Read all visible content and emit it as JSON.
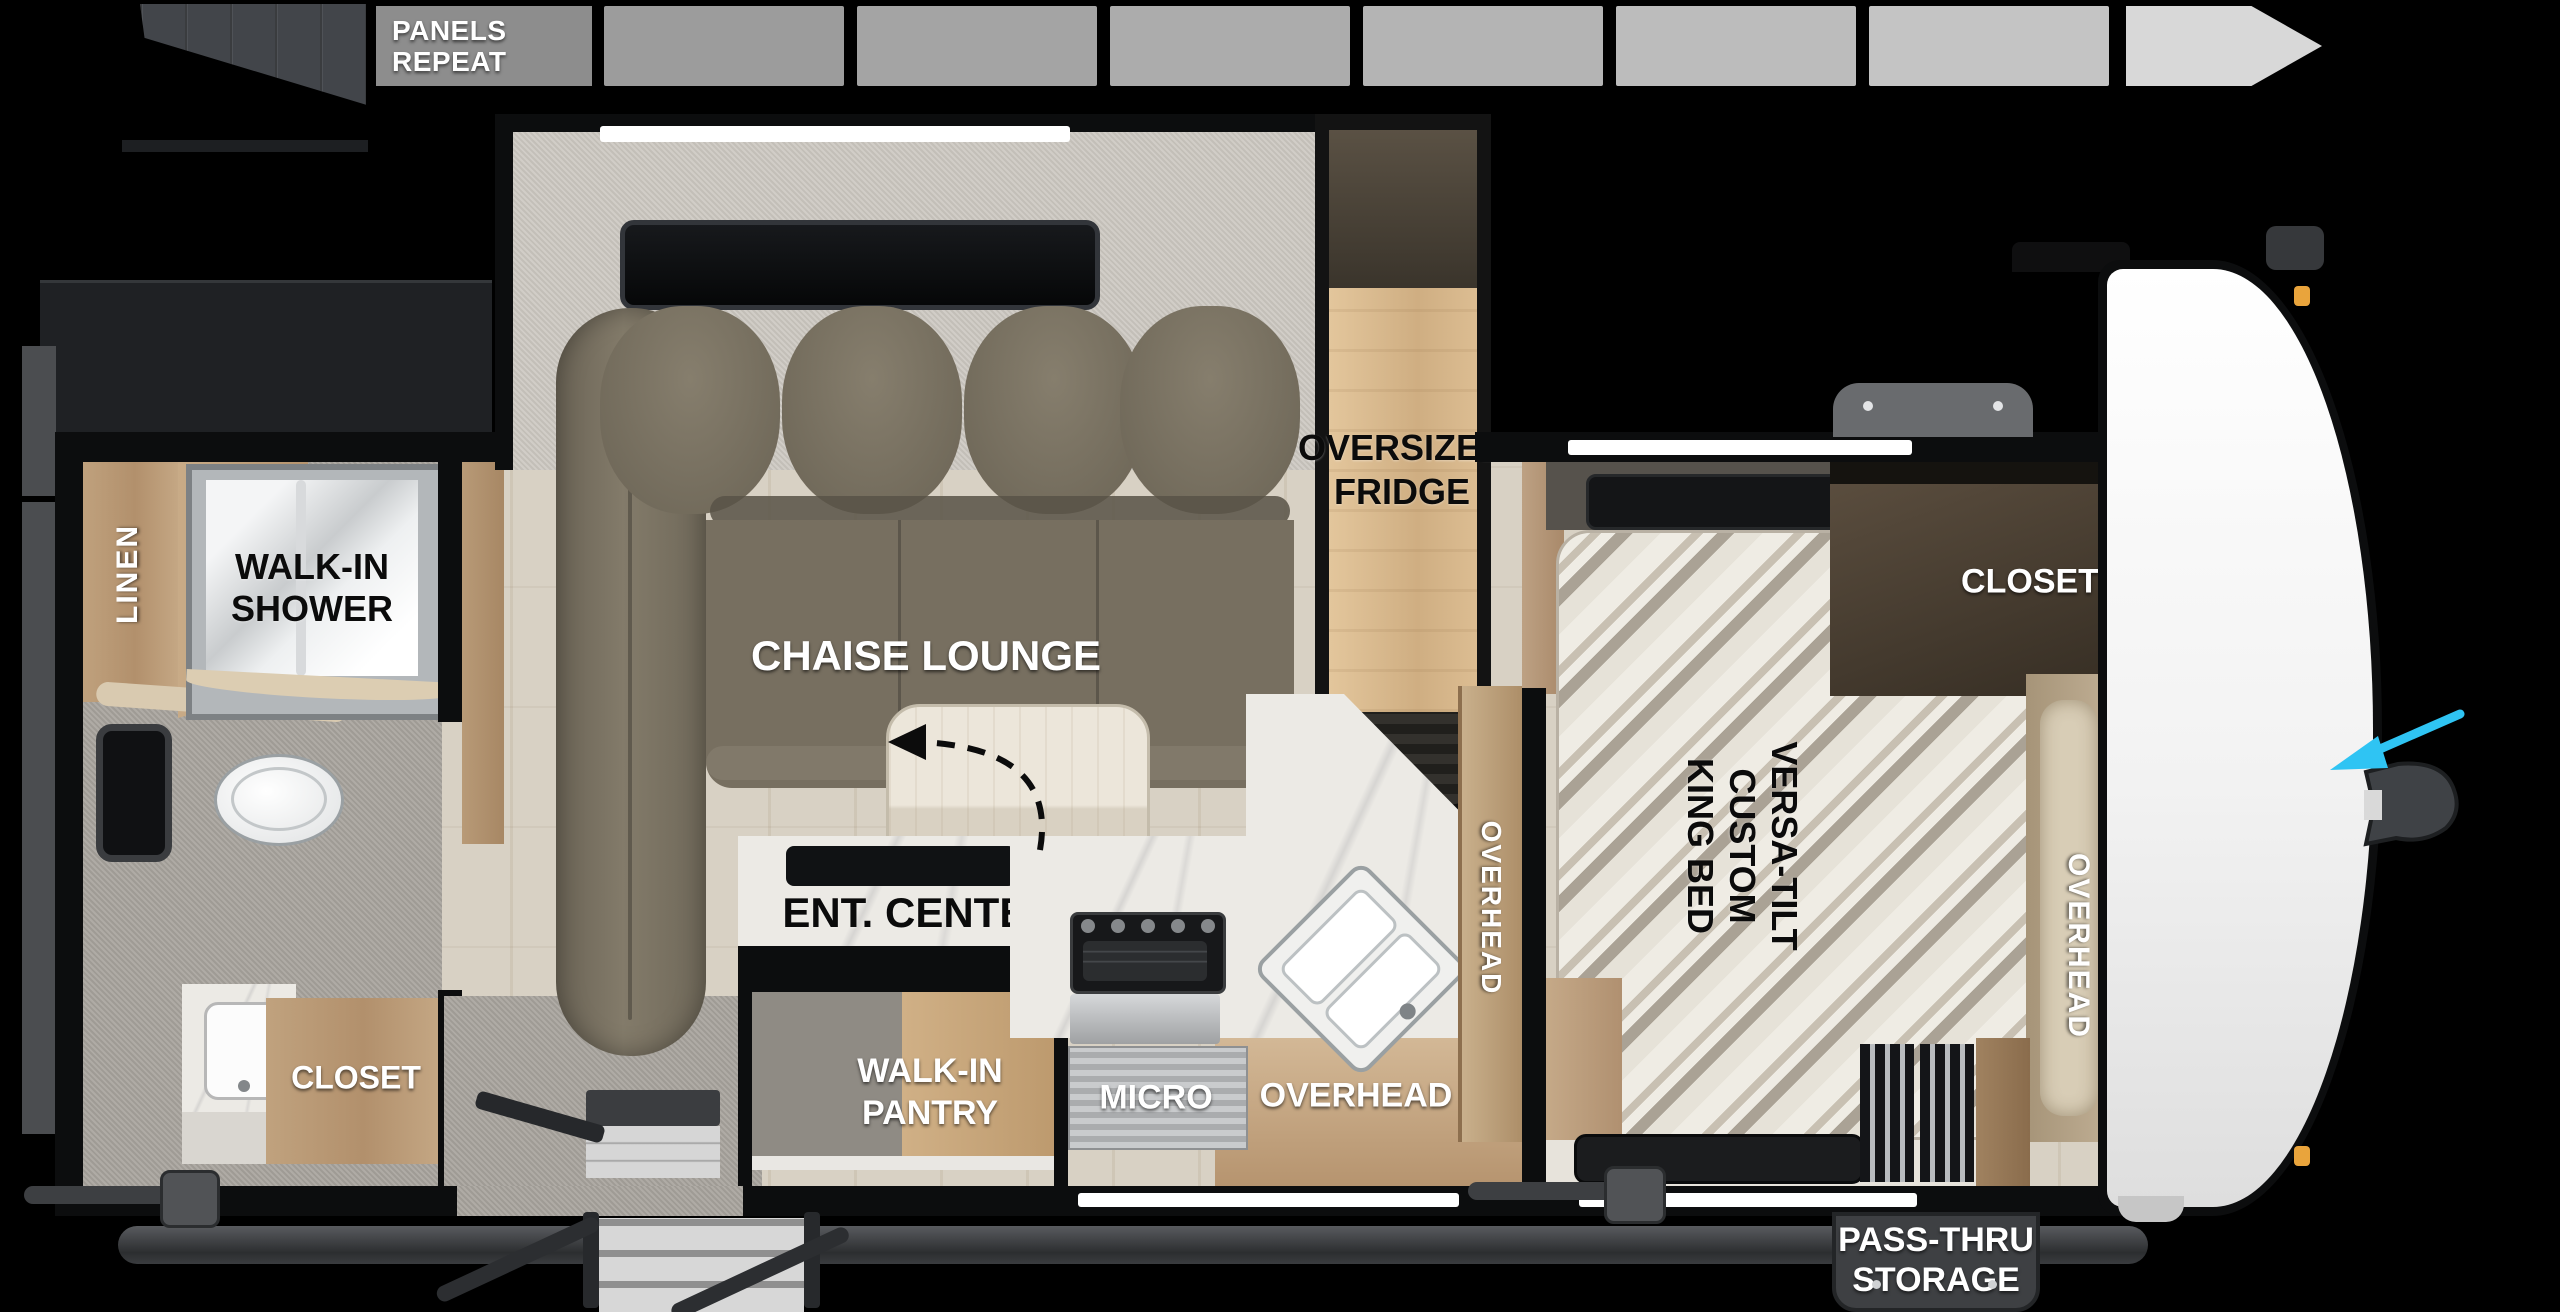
{
  "page": {
    "background": "#000000",
    "type": "travel-trailer floor plan"
  },
  "top_strip": {
    "icon": "siding-panels-icon",
    "label": {
      "l1": "PANELS",
      "l2": "REPEAT"
    },
    "label_bg": "#8d8d8d",
    "panel_colors": [
      "#9c9c9c",
      "#a4a4a4",
      "#acacac",
      "#b4b4b4",
      "#bcbcbc",
      "#c4c4c4"
    ],
    "arrow_color": "#d8d8d8"
  },
  "labels": {
    "linen": "LINEN",
    "shower": {
      "l1": "WALK-IN",
      "l2": "SHOWER"
    },
    "bath_closet": "CLOSET",
    "chaise": "CHAISE LOUNGE",
    "fridge": {
      "l1": "OVERSIZED",
      "l2": "FRIDGE"
    },
    "ent_center": {
      "l1": "ENT. CENTER",
      "l2": "W/ FIREPLACE"
    },
    "pantry": {
      "l1": "WALK-IN",
      "l2": "PANTRY"
    },
    "micro": "MICRO",
    "overhead_kitchen": "OVERHEAD",
    "overhead_kitchen_tall": "OVERHEAD",
    "bed": {
      "l1": "VERSA-TILT",
      "l2": "CUSTOM",
      "l3": "KING BED"
    },
    "bed_closet": "CLOSET",
    "overhead_bedroom": "OVERHEAD",
    "passthru": {
      "l1": "PASS-THRU",
      "l2": "STORAGE"
    }
  },
  "colors": {
    "direction_arrow": "#2fc4f3",
    "clearance_light": "#e9a43c",
    "sofa": "#7a7263",
    "cabinet_wood": "#c0a27e",
    "fridge_wood": "#dcbd92",
    "marble": "#eceae5",
    "frame_rail": "#3c3e41",
    "pass_thru_flap": "#3e4043"
  }
}
